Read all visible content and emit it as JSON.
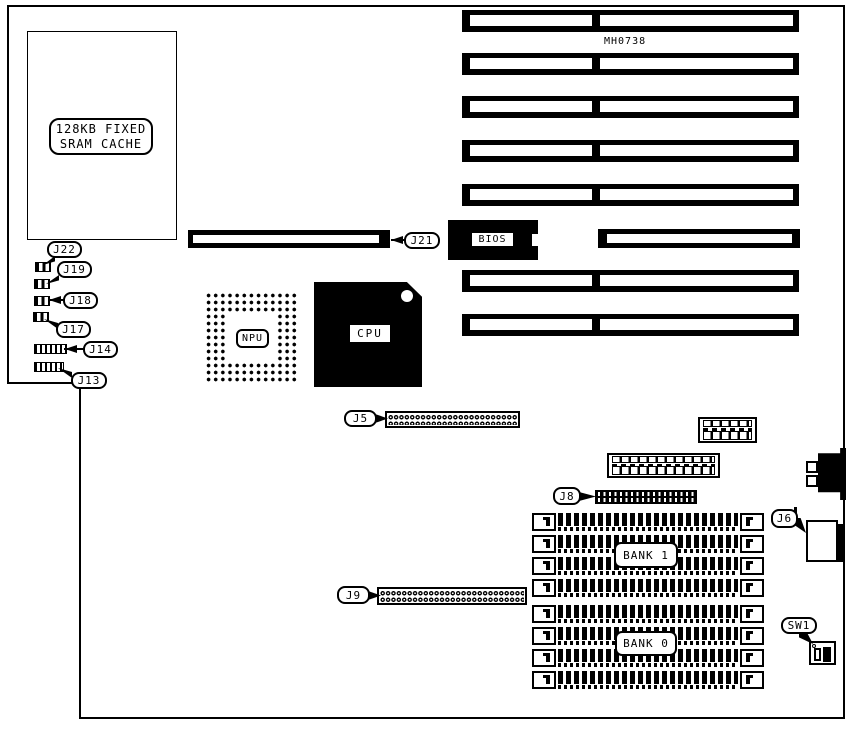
{
  "diagram": {
    "board_id": "MH0738",
    "cache_label": {
      "line1": "128KB FIXED",
      "line2": "SRAM CACHE"
    },
    "chips": {
      "bios": "BIOS",
      "npu": "NPU",
      "cpu": "CPU"
    },
    "banks": {
      "bank1": "BANK 1",
      "bank0": "BANK 0"
    },
    "callouts": {
      "j22": "J22",
      "j19": "J19",
      "j18": "J18",
      "j17": "J17",
      "j14": "J14",
      "j13": "J13",
      "j21": "J21",
      "j5": "J5",
      "j8": "J8",
      "j9": "J9",
      "j6": "J6",
      "sw1": "SW1"
    },
    "components": {
      "isa_slots": 8,
      "simm_sockets_bank1": 4,
      "simm_sockets_bank0": 4
    },
    "colors": {
      "ink": "#000000",
      "paper": "#ffffff"
    }
  }
}
